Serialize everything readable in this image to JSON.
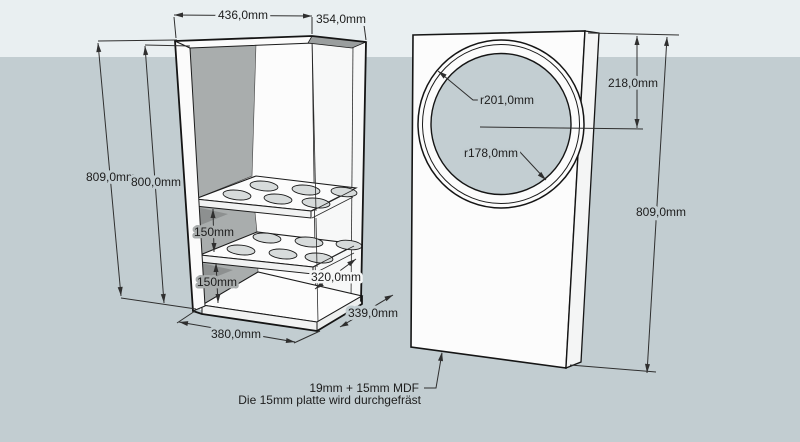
{
  "drawing": {
    "type": "3d-cad-sketch",
    "objects": [
      "cabinet-carcass-with-shelves",
      "front-baffle-with-circular-cutout"
    ]
  },
  "dimensions": {
    "top_width": "436,0mm",
    "top_depth": "354,0mm",
    "left_outer_height": "809,0mm",
    "left_inner_height": "800,0mm",
    "shelf_spacing_upper": "150mm",
    "shelf_spacing_lower": "150mm",
    "shelf_depth": "320,0mm",
    "bottom_depth": "339,0mm",
    "bottom_width": "380,0mm",
    "front_outer_radius": "r201,0mm",
    "front_inner_radius": "r178,0mm",
    "circle_center_from_top": "218,0mm",
    "front_panel_height": "809,0mm"
  },
  "notes": {
    "material": "19mm + 15mm MDF",
    "milling": "Die 15mm platte wird durchgefräst"
  },
  "colors": {
    "sky": "#e9eff1",
    "ground": "#c2cdd1",
    "face_white": "#fcfcfc",
    "shadow_wall": "#a9adad",
    "shadow_dark": "#8d9090",
    "hole_fill": "#c3ced2",
    "edge_line": "#151515",
    "dimension_line": "#2f2f2f"
  }
}
